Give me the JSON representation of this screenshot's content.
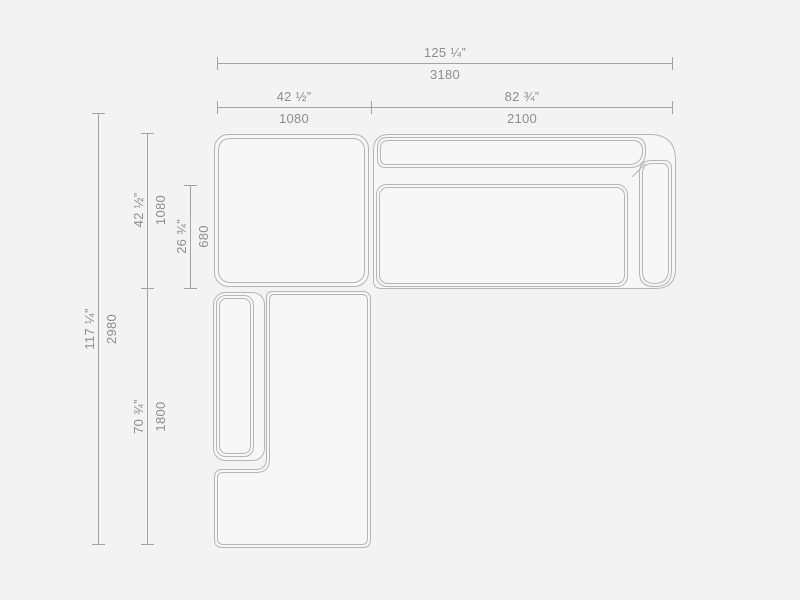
{
  "drawing": {
    "type": "sectional-sofa-plan-dimension-diagram",
    "colors": {
      "background": "#f3f3f3",
      "shape_fill": "#f7f7f7",
      "furniture_line": "#b5b5b5",
      "dimension_line": "#a3a3a3",
      "text": "#8d8d8d"
    },
    "dimensions": {
      "overall_width": {
        "inches": "125 ¼”",
        "mm": "3180"
      },
      "ottoman_width": {
        "inches": "42 ½”",
        "mm": "1080"
      },
      "sofa_width": {
        "inches": "82 ¾”",
        "mm": "2100"
      },
      "overall_depth": {
        "inches": "117 ¼”",
        "mm": "2980"
      },
      "ottoman_depth": {
        "inches": "42 ½”",
        "mm": "1080"
      },
      "seat_depth": {
        "inches": "26 ¾”",
        "mm": "680"
      },
      "chaise_length": {
        "inches": "70 ¾”",
        "mm": "1800"
      }
    }
  }
}
